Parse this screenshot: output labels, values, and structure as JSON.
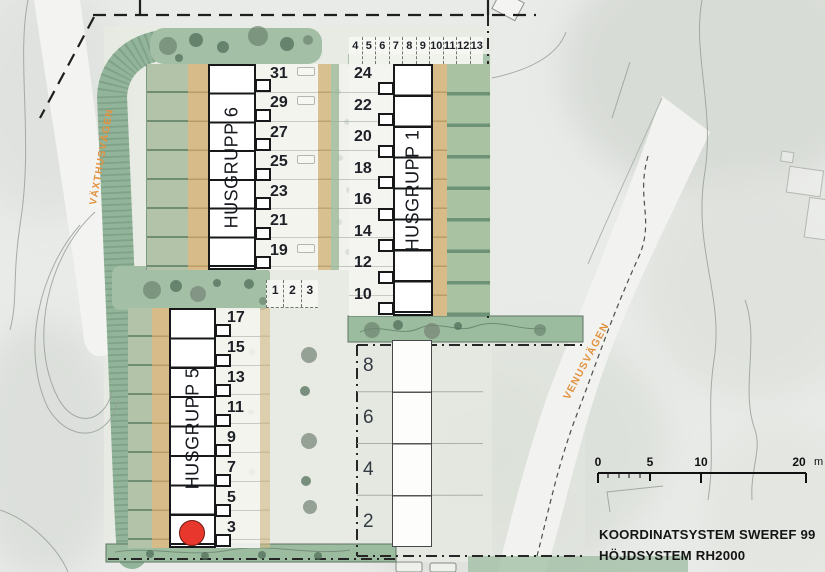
{
  "groups": {
    "g6": {
      "label": "HUSGRUPP 6",
      "units": [
        "31",
        "29",
        "27",
        "25",
        "23",
        "21",
        "19"
      ]
    },
    "g1": {
      "label": "HUSGRUPP 1",
      "units": [
        "24",
        "22",
        "20",
        "18",
        "16",
        "14",
        "12",
        "10"
      ],
      "parking_row": [
        "4",
        "5",
        "6",
        "7",
        "8",
        "9",
        "10",
        "11",
        "12",
        "13"
      ]
    },
    "g5": {
      "label": "HUSGRUPP 5",
      "units": [
        "17",
        "15",
        "13",
        "11",
        "9",
        "7",
        "5",
        "3"
      ]
    },
    "future": {
      "units": [
        "8",
        "6",
        "4",
        "2"
      ]
    }
  },
  "visitor_parking": {
    "spaces": [
      "1",
      "2",
      "3"
    ]
  },
  "streets": {
    "vaxthusvagen": "VÄXTHUSVÄGEN",
    "venusvagen": "VENUSVÄGEN"
  },
  "scale_bar": {
    "labels": [
      "0",
      "5",
      "10",
      "20"
    ],
    "unit": "m"
  },
  "reference": {
    "coordinate_system": "KOORDINATSYSTEM SWEREF 99",
    "height_system": "HÖJDSYSTEM RH2000"
  },
  "marker": {
    "name": "red-dot-marker",
    "color": "#e8382d"
  },
  "colors": {
    "building_outline": "#17181a",
    "garden_green": "#aec3a6",
    "hedge_green": "#92b49a",
    "patio_tan": "#d7bc89",
    "street_label_orange": "#e2923f",
    "future_outline": "#46494c",
    "boundary_black": "#222222"
  }
}
